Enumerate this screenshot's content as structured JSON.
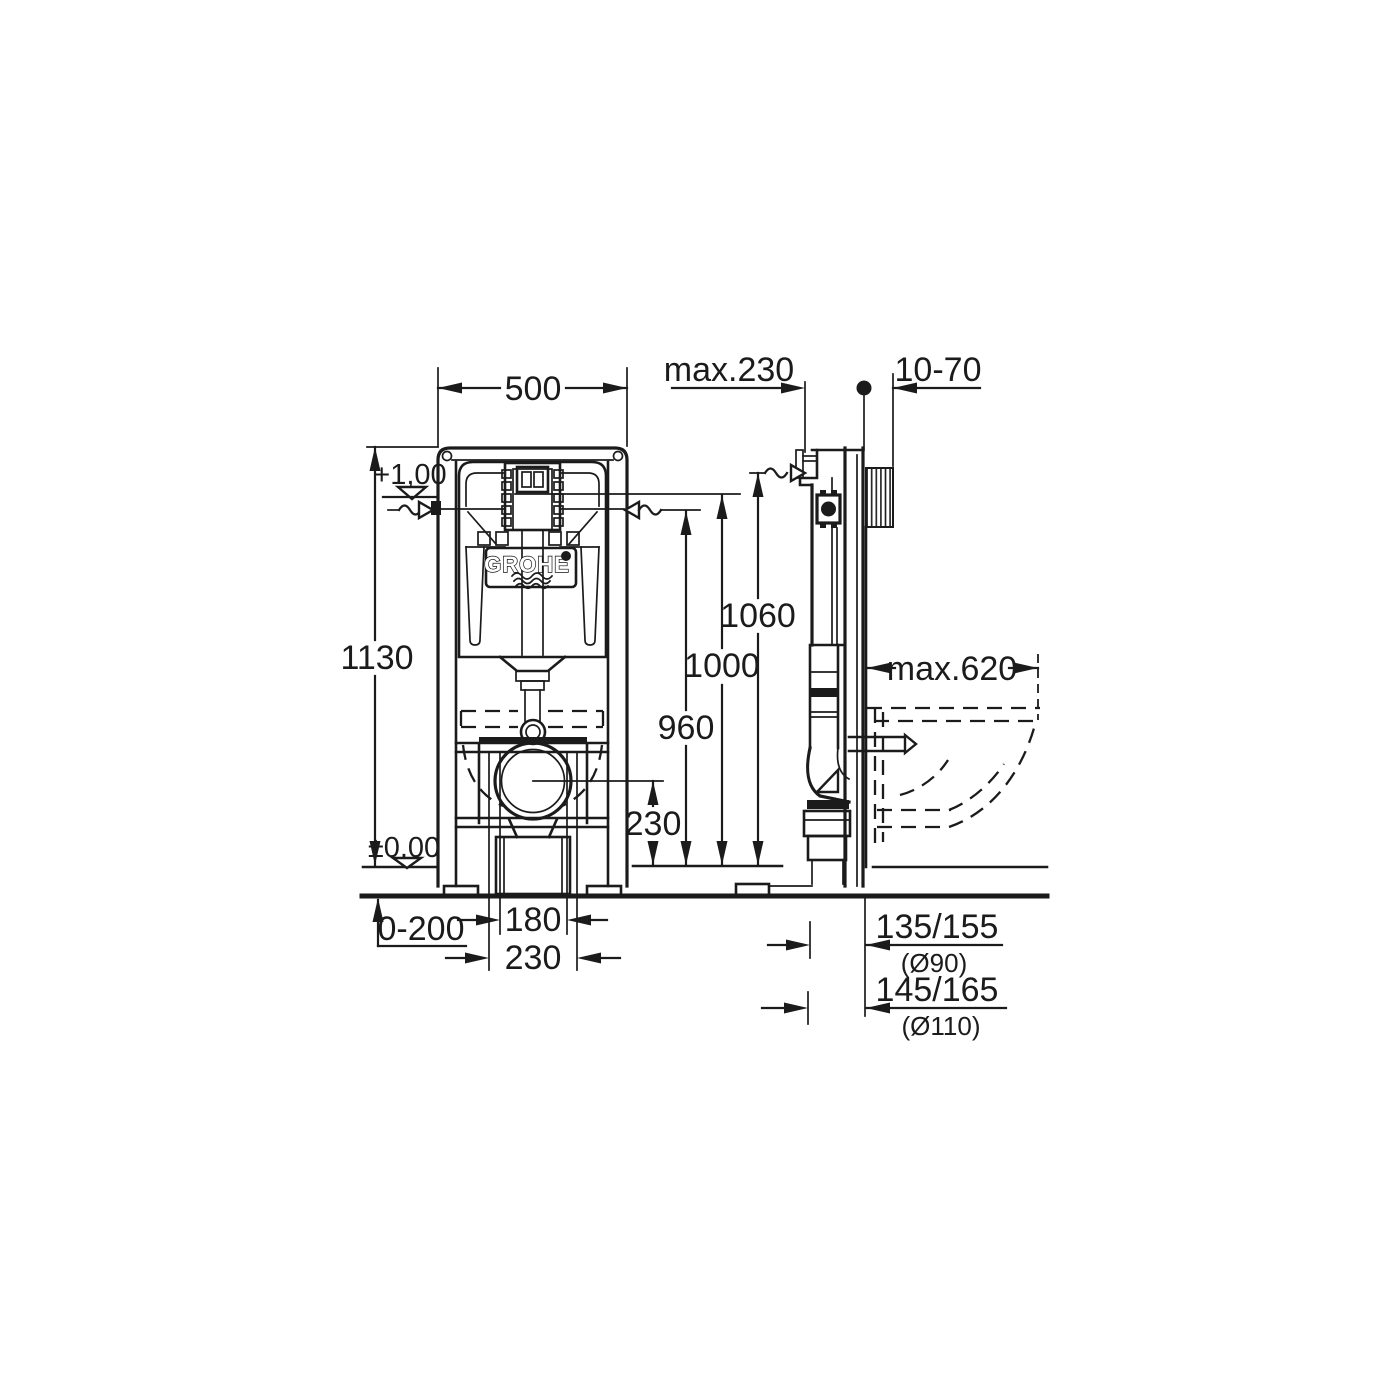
{
  "drawing": {
    "type": "technical-installation-drawing",
    "brand": "GROHE",
    "colors": {
      "line": "#1b1b1b",
      "background": "#ffffff"
    },
    "labels": {
      "width_front": "500",
      "height_frame": "1130",
      "level_plus": "+1,00",
      "level_zero": "±0,00",
      "floor_adjust": "0-200",
      "bolt_spacing": "180",
      "drain_spacing": "230",
      "outlet_height": "230",
      "flush_level": "960",
      "actuator_height": "1000",
      "inlet_height": "1060",
      "depth_max": "max.230",
      "wall_range": "10-70",
      "bowl_depth": "max.620",
      "drain_90": "135/155",
      "drain_90_dia": "(Ø90)",
      "drain_110": "145/165",
      "drain_110_dia": "(Ø110)"
    }
  }
}
